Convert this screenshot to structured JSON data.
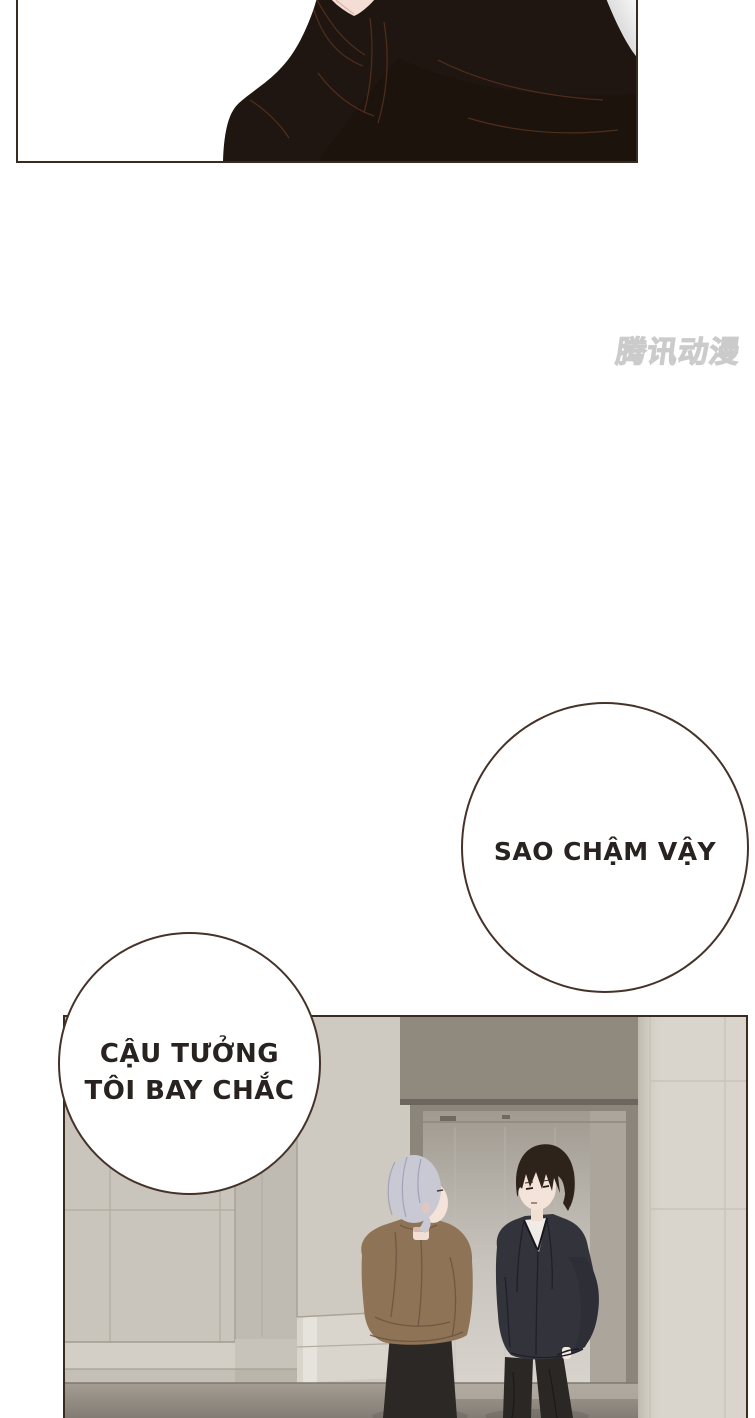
{
  "watermark": {
    "text": "腾讯动漫"
  },
  "bubbles": {
    "bubble1": {
      "text": "SAO CHẬM VẬY"
    },
    "bubble2": {
      "line1": "CẬU TƯỞNG",
      "line2": "TÔI BAY CHẮC"
    }
  },
  "colors": {
    "page_bg": "#ffffff",
    "panel_border": "#3a2b21",
    "bubble_border": "#453229",
    "text": "#282320",
    "figure_dark": "#201611",
    "fold_line": "#5d341f",
    "skin": "#f4e3d9",
    "hair_silver": "#c9c9d4",
    "hair_dark": "#2d231b",
    "shirt_brown": "#8e7356",
    "jacket_dark": "#33333b",
    "pants_dark": "#2a2724",
    "wall_beige": "#cac5bc",
    "wall_cream": "#d9d5cc",
    "lintel_taupe": "#8f897e",
    "floor_gray": "#9a938a"
  }
}
